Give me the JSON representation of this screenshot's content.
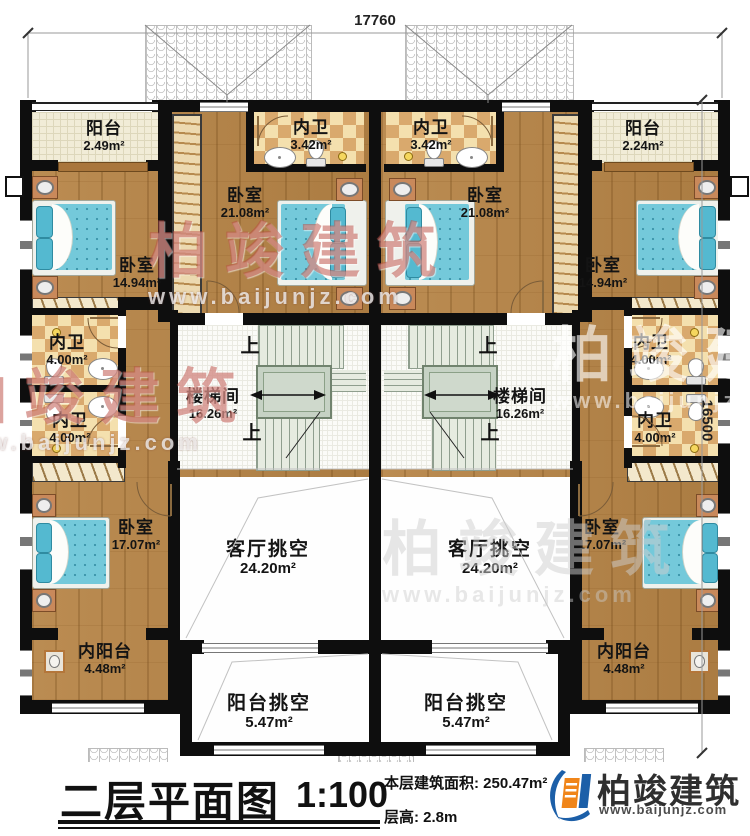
{
  "dimensions": {
    "top": "17760",
    "right": "16500"
  },
  "stairs": {
    "up_label": "上"
  },
  "watermark": {
    "brand": "柏竣建筑",
    "url": "www.baijunjz.com"
  },
  "rooms": [
    {
      "name": "阳台",
      "area": "2.49m²"
    },
    {
      "name": "内卫",
      "area": "3.42m²"
    },
    {
      "name": "内卫",
      "area": "3.42m²"
    },
    {
      "name": "阳台",
      "area": "2.24m²"
    },
    {
      "name": "卧室",
      "area": "21.08m²"
    },
    {
      "name": "卧室",
      "area": "21.08m²"
    },
    {
      "name": "卧室",
      "area": "14.94m²"
    },
    {
      "name": "卧室",
      "area": "14.94m²"
    },
    {
      "name": "内卫",
      "area": "4.00m²"
    },
    {
      "name": "内卫",
      "area": "4.00m²"
    },
    {
      "name": "楼梯间",
      "area": "16.26m²"
    },
    {
      "name": "楼梯间",
      "area": "16.26m²"
    },
    {
      "name": "内卫",
      "area": "4.00m²"
    },
    {
      "name": "内卫",
      "area": "4.00m²"
    },
    {
      "name": "卧室",
      "area": "17.07m²"
    },
    {
      "name": "卧室",
      "area": "17.07m²"
    },
    {
      "name": "客厅挑空",
      "area": "24.20m²"
    },
    {
      "name": "客厅挑空",
      "area": "24.20m²"
    },
    {
      "name": "内阳台",
      "area": "4.48m²"
    },
    {
      "name": "内阳台",
      "area": "4.48m²"
    },
    {
      "name": "阳台挑空",
      "area": "5.47m²"
    },
    {
      "name": "阳台挑空",
      "area": "5.47m²"
    }
  ],
  "footer": {
    "title": "二层平面图",
    "scale": "1:100",
    "area_label": "本层建筑面积:",
    "area_value": "250.47m²",
    "floor_height_label": "层高:",
    "floor_height_value": "2.8m",
    "brand": "柏竣建筑",
    "brand_url": "www.baijunjz.com"
  },
  "colors": {
    "wall": "#0e0e0e",
    "wood": "#b5864c",
    "logo_blue": "#1c5fa8",
    "logo_orange": "#f08519"
  }
}
